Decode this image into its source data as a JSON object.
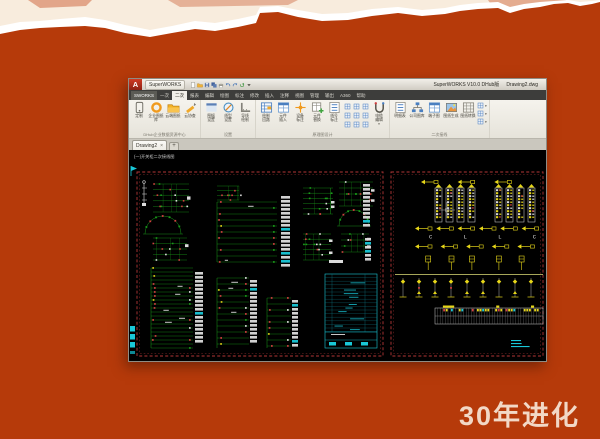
{
  "slide": {
    "caption": "30年进化",
    "colors": {
      "background_orange": "#b63a0a",
      "paper_cream": "#f8ecdd",
      "tear_white": "#ffffff",
      "caption_text": "#f2d8c6"
    }
  },
  "window": {
    "titlebar": {
      "app_letter": "A",
      "app_name": "SuperWORKS",
      "app_dropdown": "▾",
      "quick_icons": [
        "new-doc",
        "open-folder",
        "save",
        "save-all",
        "plot",
        "undo-arrow",
        "redo-arrow",
        "refresh",
        "dropdown"
      ],
      "version_title": "SuperWORKS V10.0 DHub版",
      "doc_name": "Drawing2.dwg"
    },
    "ribbon_tabs": [
      {
        "label": "SWORKS",
        "active": false,
        "first": true
      },
      {
        "label": "一次",
        "active": false
      },
      {
        "label": "二次",
        "active": true
      },
      {
        "label": "报表",
        "active": false
      },
      {
        "label": "编辑",
        "active": false
      },
      {
        "label": "绘图",
        "active": false
      },
      {
        "label": "标注",
        "active": false
      },
      {
        "label": "修改",
        "active": false
      },
      {
        "label": "插入",
        "active": false
      },
      {
        "label": "注释",
        "active": false
      },
      {
        "label": "视图",
        "active": false
      },
      {
        "label": "管理",
        "active": false
      },
      {
        "label": "输出",
        "active": false
      },
      {
        "label": "A360",
        "active": false
      },
      {
        "label": "帮助",
        "active": false
      }
    ],
    "ribbon_groups": [
      {
        "label": "DHub企业数据资源中心",
        "buttons": [
          {
            "label": "定制",
            "icon": "phone"
          },
          {
            "label": "企业图纸库",
            "icon": "ring"
          },
          {
            "label": "云端图纸",
            "icon": "folder"
          },
          {
            "label": "云协查",
            "icon": "pencil"
          }
        ]
      },
      {
        "label": "设置",
        "buttons": [
          {
            "label": "图幅\n设置",
            "icon": "frame"
          },
          {
            "label": "线型\n设置",
            "icon": "compass"
          },
          {
            "label": "导线\n绘制",
            "icon": "ruler"
          }
        ]
      },
      {
        "label": "原理图设计",
        "buttons": [
          {
            "label": "绘制\n回路",
            "icon": "grid-edit"
          },
          {
            "label": "元件\n插入",
            "icon": "table-blue"
          },
          {
            "label": "设备\n标注",
            "icon": "star"
          },
          {
            "label": "元件\n替换",
            "icon": "table-plus"
          },
          {
            "label": "线号\n标注",
            "icon": "list"
          }
        ],
        "smalls": 9,
        "tail_buttons": [
          {
            "label": "电缆\n编辑",
            "icon": "cable",
            "dropdown": "▾"
          }
        ]
      },
      {
        "label": "二次接线",
        "buttons": [
          {
            "label": "明细表",
            "icon": "list"
          },
          {
            "label": "公司图库",
            "icon": "org"
          },
          {
            "label": "端子图",
            "icon": "table-blue"
          },
          {
            "label": "图纸生成",
            "icon": "photo"
          },
          {
            "label": "图纸转换",
            "icon": "table-gray"
          }
        ],
        "stack_smalls": 3
      }
    ],
    "file_tabs": {
      "tabs": [
        {
          "label": "Drawing2",
          "close": "×"
        }
      ],
      "add_label": "+"
    },
    "canvas": {
      "corner_label": "(一)开关柜二次接线图",
      "letters_row": "C  L  L  C  C",
      "palette": {
        "schematic_green": "#1a9a1a",
        "mark_red": "#d04040",
        "mark_white": "#dcdcdc",
        "wire_yellow": "#e6d619",
        "table_cyan": "#19c8d8",
        "sheet_border_red": "#b23636"
      },
      "sheets": [
        {
          "x": 8,
          "y": 22,
          "w": 246,
          "h": 184
        },
        {
          "x": 262,
          "y": 22,
          "w": 152,
          "h": 184
        }
      ],
      "markers": [
        {
          "type": "flag",
          "x": 2,
          "y": 16
        },
        {
          "type": "stack",
          "x": 1,
          "y": 176
        }
      ],
      "clusters": [
        {
          "t": "pole",
          "x": 13,
          "y": 30,
          "w": 8,
          "h": 26
        },
        {
          "t": "grid",
          "x": 24,
          "y": 34,
          "w": 36,
          "h": 28
        },
        {
          "t": "arc",
          "x": 16,
          "y": 66,
          "w": 36,
          "h": 18
        },
        {
          "t": "grid",
          "x": 24,
          "y": 88,
          "w": 34,
          "h": 22
        },
        {
          "t": "rows",
          "x": 88,
          "y": 36,
          "w": 26,
          "h": 14
        },
        {
          "t": "ladder",
          "x": 88,
          "y": 52,
          "w": 60,
          "h": 60
        },
        {
          "t": "white-col",
          "x": 152,
          "y": 46,
          "w": 11,
          "h": 72
        },
        {
          "t": "grid",
          "x": 174,
          "y": 38,
          "w": 30,
          "h": 26
        },
        {
          "t": "grid",
          "x": 174,
          "y": 84,
          "w": 28,
          "h": 26
        },
        {
          "t": "grid",
          "x": 210,
          "y": 32,
          "w": 34,
          "h": 24
        },
        {
          "t": "arc",
          "x": 210,
          "y": 60,
          "w": 30,
          "h": 16
        },
        {
          "t": "grid",
          "x": 212,
          "y": 84,
          "w": 28,
          "h": 18
        },
        {
          "t": "white-col",
          "x": 234,
          "y": 34,
          "w": 9,
          "h": 44
        },
        {
          "t": "white-col",
          "x": 236,
          "y": 88,
          "w": 8,
          "h": 26
        },
        {
          "t": "white-bar",
          "x": 200,
          "y": 110,
          "w": 14,
          "h": 3
        },
        {
          "t": "ladder-dense",
          "x": 22,
          "y": 118,
          "w": 42,
          "h": 80
        },
        {
          "t": "white-col",
          "x": 66,
          "y": 122,
          "w": 10,
          "h": 72
        },
        {
          "t": "ladder",
          "x": 88,
          "y": 128,
          "w": 32,
          "h": 70
        },
        {
          "t": "white-col",
          "x": 121,
          "y": 130,
          "w": 9,
          "h": 64
        },
        {
          "t": "ladder",
          "x": 138,
          "y": 148,
          "w": 24,
          "h": 50
        },
        {
          "t": "white-col",
          "x": 163,
          "y": 150,
          "w": 8,
          "h": 48
        },
        {
          "t": "cyan-table",
          "x": 196,
          "y": 124,
          "w": 52,
          "h": 74
        },
        {
          "t": "arrows",
          "x": 292,
          "y": 28,
          "w": 110,
          "h": 8,
          "n": 3
        },
        {
          "t": "term-strips",
          "x": 306,
          "y": 38,
          "w": 50,
          "h": 34
        },
        {
          "t": "term-strips",
          "x": 366,
          "y": 38,
          "w": 48,
          "h": 34
        },
        {
          "t": "arrows",
          "x": 286,
          "y": 74,
          "w": 128,
          "h": 9,
          "n": 6
        },
        {
          "t": "letters",
          "x": 300,
          "y": 83,
          "w": 104,
          "h": 7
        },
        {
          "t": "arrows",
          "x": 286,
          "y": 92,
          "w": 128,
          "h": 9,
          "n": 5
        },
        {
          "t": "ysymbols",
          "x": 292,
          "y": 106,
          "w": 120,
          "h": 14
        },
        {
          "t": "hline",
          "x": 266,
          "y": 124,
          "w": 148,
          "h": 1
        },
        {
          "t": "tpoles",
          "x": 270,
          "y": 128,
          "w": 144,
          "h": 22
        },
        {
          "t": "table-strip",
          "x": 306,
          "y": 158,
          "w": 108,
          "h": 16
        },
        {
          "t": "cyan-text",
          "x": 382,
          "y": 190,
          "w": 30,
          "h": 8
        },
        {
          "t": "crosshair",
          "x": 318,
          "y": 60,
          "w": 16,
          "h": 16
        }
      ]
    }
  }
}
